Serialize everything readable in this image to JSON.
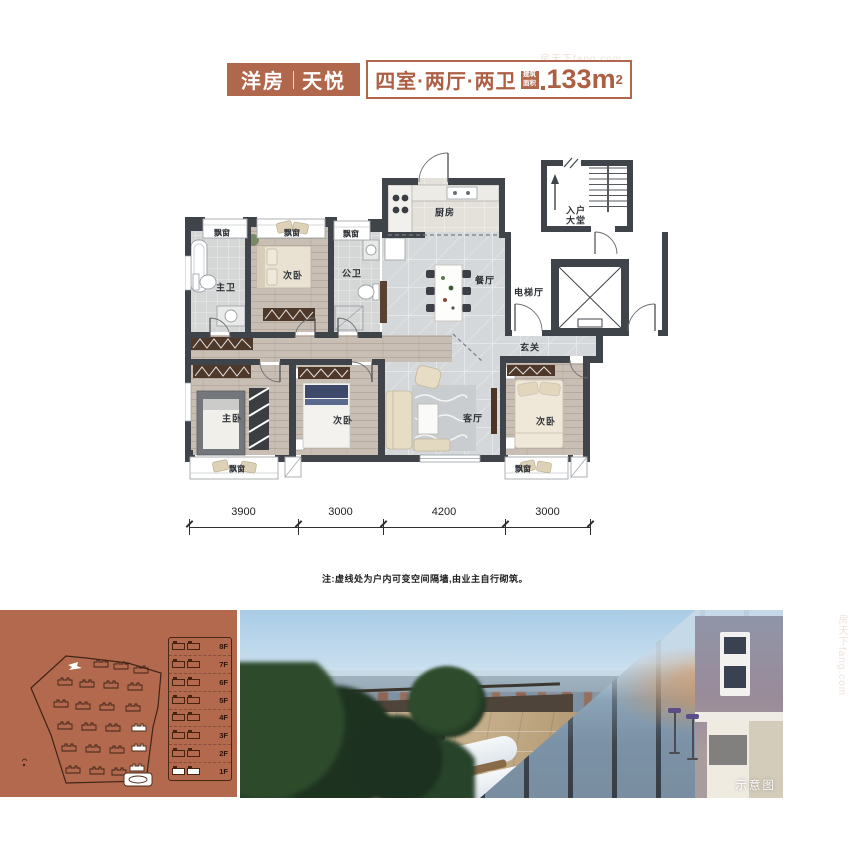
{
  "watermark": {
    "text": "房天下fang.com"
  },
  "header": {
    "series": "洋房",
    "name": "天悦",
    "layout": "四室·两厅·两卫",
    "area_badge_line1": "建筑",
    "area_badge_line2": "面积",
    "area_value": "133m",
    "area_sup": "2"
  },
  "plan": {
    "rooms": {
      "bay_window": "飘窗",
      "master_bath": "主卫",
      "bedroom": "次卧",
      "public_bath": "公卫",
      "kitchen": "厨房",
      "entry_hall_line1": "入户",
      "entry_hall_line2": "大堂",
      "dining": "餐厅",
      "elevator_hall": "电梯厅",
      "foyer": "玄关",
      "living": "客厅",
      "master_bedroom": "主卧"
    },
    "dims": [
      "3900",
      "3000",
      "4200",
      "3000"
    ],
    "note": "注:虚线处为户内可变空间隔墙,由业主自行砌筑。"
  },
  "siteplan": {
    "floors": [
      "8F",
      "7F",
      "6F",
      "5F",
      "4F",
      "3F",
      "2F",
      "1F"
    ]
  },
  "photo": {
    "caption": "示意图"
  }
}
